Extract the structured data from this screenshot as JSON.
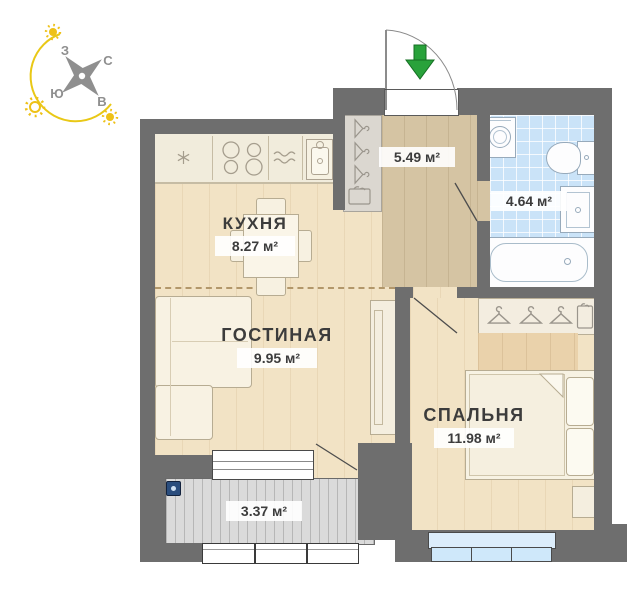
{
  "compass": {
    "west": "З",
    "north": "С",
    "south": "Ю",
    "east": "В"
  },
  "rooms": {
    "kitchen": {
      "name": "КУХНЯ",
      "area": "8.27 м²"
    },
    "living": {
      "name": "ГОСТИНАЯ",
      "area": "9.95 м²"
    },
    "bedroom": {
      "name": "СПАЛЬНЯ",
      "area": "11.98 м²"
    },
    "hallway": {
      "area": "5.49 м²"
    },
    "bathroom": {
      "area": "4.64 м²"
    },
    "balcony": {
      "area": "3.37 м²"
    }
  },
  "colors": {
    "wall": "#6e6e6e",
    "wood_floor": "#f2e3c5",
    "hall_floor": "#d5c4a3",
    "tile_floor": "#cae3f8",
    "balcony_floor": "#dadada",
    "entrance_arrow_green": "#29a23b",
    "compass_yellow": "#e9c816",
    "window_blue": "#cfe8fa"
  }
}
